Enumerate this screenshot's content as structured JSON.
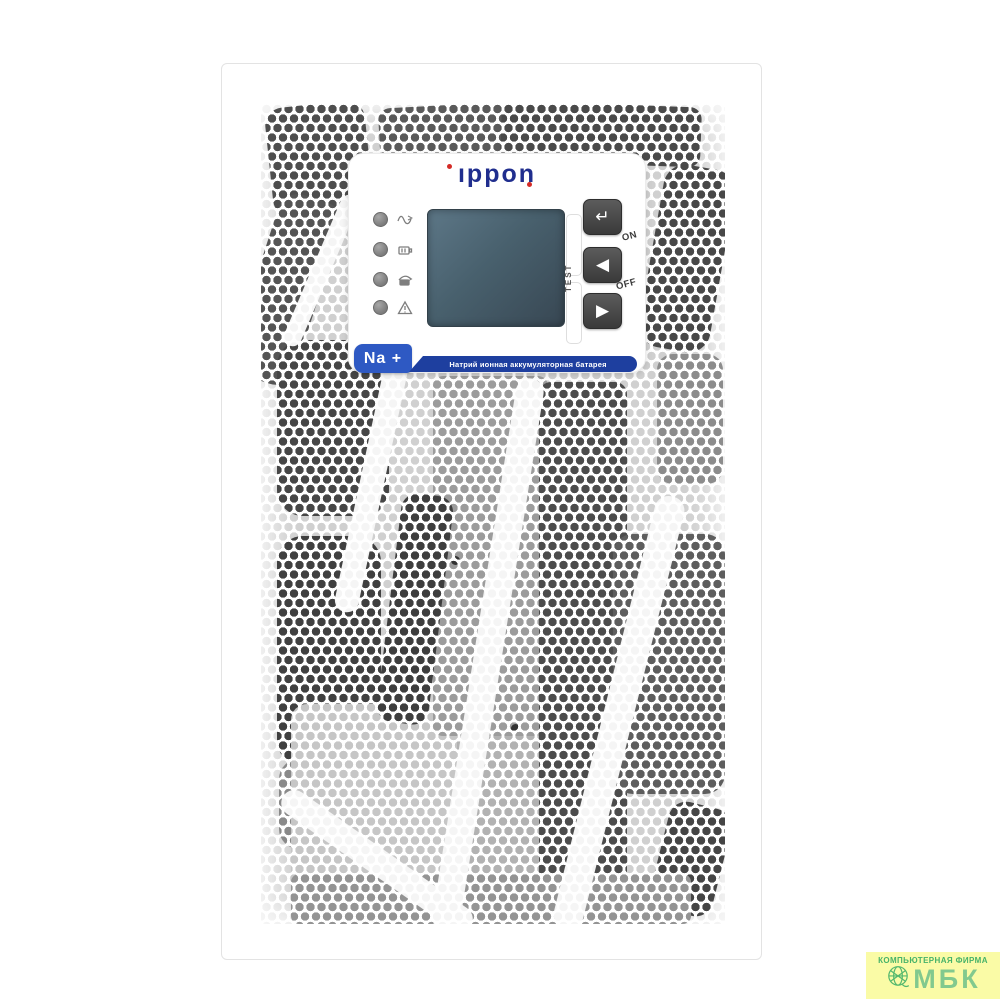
{
  "brand": {
    "name": "ippon",
    "display": "ıppon"
  },
  "control_panel": {
    "leds": [
      {
        "icon": "ac-normal-icon"
      },
      {
        "icon": "battery-icon"
      },
      {
        "icon": "bypass-icon"
      },
      {
        "icon": "fault-icon"
      }
    ],
    "buttons": {
      "enter": "↵",
      "left": "◀",
      "right": "▶"
    },
    "labels": {
      "test": "TEST",
      "on": "ON",
      "off": "OFF"
    },
    "badge": {
      "title": "Na +",
      "caption": "Натрий ионная аккумуляторная батарея"
    }
  },
  "watermark": {
    "line1": "КОМПЬЮТЕРНАЯ ФИРМА",
    "line2": "МБК"
  },
  "colors": {
    "logo_navy": "#202e8e",
    "logo_red": "#d42b26",
    "badge_blue": "#2e59c3",
    "badge_strip_blue": "#1e3f9f",
    "lcd_slate": "#465962",
    "button_dark": "#444444",
    "watermark_bg": "#fafba6",
    "watermark_green": "#46b269"
  }
}
